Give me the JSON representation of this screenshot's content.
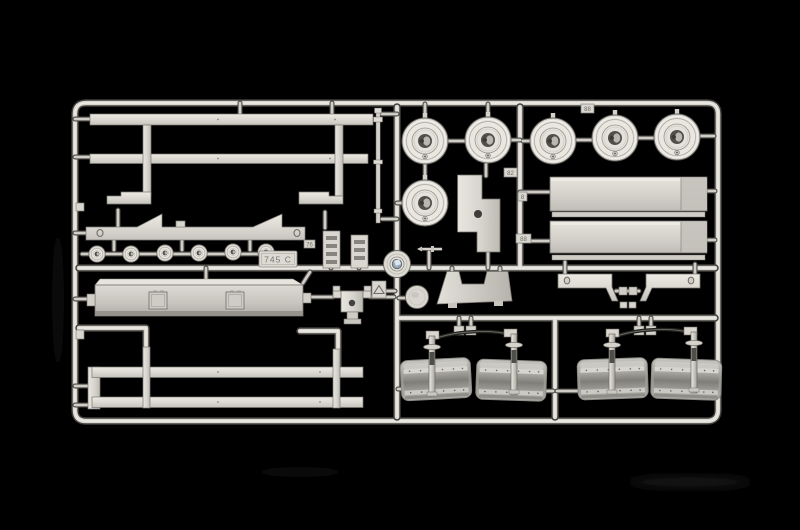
{
  "meta": {
    "subject": "Photograph of an injection-molded plastic model kit sprue (parts tree) with truck trailer parts, light gray plastic on a black background",
    "background_color": "#000000",
    "plastic_color": "#d8d6d0",
    "plastic_highlight": "#f1f0ea",
    "plastic_shadow": "#6f6d67",
    "accent_color": "#93a7b8"
  },
  "sprue": {
    "code_tag": "745 C",
    "gate_tags": [
      "88",
      "82",
      "8",
      "88",
      "76"
    ],
    "part_inventory": [
      {
        "part": "large wheel hubs",
        "count": 6
      },
      {
        "part": "small road wheels",
        "count": 6
      },
      {
        "part": "upper chassis rail ladder",
        "count": 1
      },
      {
        "part": "lower chassis rail ladder",
        "count": 1
      },
      {
        "part": "long deck panels with edge strips",
        "count": 2
      },
      {
        "part": "notched side beam",
        "count": 1
      },
      {
        "part": "tool box with twin hatches",
        "count": 1
      },
      {
        "part": "axle and fender assemblies",
        "count": 2
      },
      {
        "part": "fenders",
        "count": 4
      },
      {
        "part": "stepped support brackets",
        "count": 2
      },
      {
        "part": "gooseneck plate with hole",
        "count": 1
      },
      {
        "part": "notched mud flap panel",
        "count": 1
      },
      {
        "part": "hub cap with blue center",
        "count": 1
      },
      {
        "part": "plain disc",
        "count": 1
      },
      {
        "part": "fifth wheel mount bracket",
        "count": 1
      },
      {
        "part": "ribbed grille blocks",
        "count": 2
      },
      {
        "part": "thin rod",
        "count": 1
      }
    ]
  }
}
